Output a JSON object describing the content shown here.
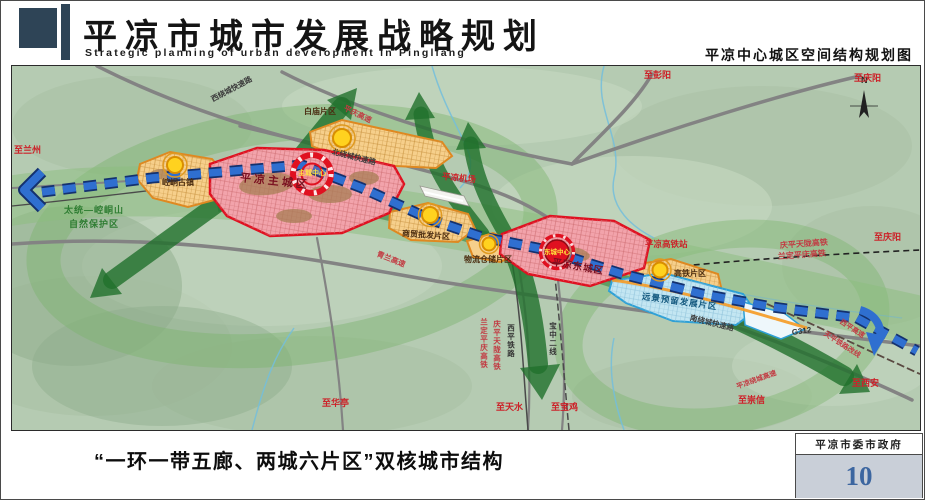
{
  "header": {
    "title_cn": "平凉市城市发展战略规划",
    "title_en": "Strategic planning of urban development in Pingliang",
    "right_caption": "平凉中心城区空间结构规划图"
  },
  "map": {
    "compass": "N",
    "zones": {
      "main_city": "平凉主城区",
      "east_city": "平凉东城区",
      "baimiao": "白庙片区",
      "kongtong": "崆峒古镇",
      "shangmao": "商贸批发片区",
      "wuliu": "物流仓储片区",
      "gaotie": "高铁片区",
      "yuanjing": "远景预留发展片区"
    },
    "centers": {
      "main": "主城中心",
      "east": "东城中心"
    },
    "stations": {
      "hsr": "平凉高铁站",
      "airport": "平凉机场"
    },
    "roads": {
      "west_ring": "西绕城快速路",
      "north_ring": "北绕城快速路",
      "south_ring": "南绕城快速路",
      "pingqing_expwy": "平庆高速",
      "qinglan_expwy": "青兰高速",
      "raocheng_expwy": "平凉绕城高速",
      "g312": "G312"
    },
    "railways": {
      "qptl_hsr": "庆平天陇高铁",
      "ldpq_hsr": "兰定平庆高铁",
      "xiping_rail": "西平铁路",
      "baozhong_2": "宝中二线",
      "xiping_expwy": "西平高速",
      "tianping_realign": "天平铁路改线"
    },
    "destinations": {
      "lanzhou": "至兰州",
      "pengyang": "至彭阳",
      "qingyang_top": "至庆阳",
      "qingyang_east": "至庆阳",
      "xian": "至西安",
      "chongxin": "至崇信",
      "huating": "至华亭",
      "tianshui": "至天水",
      "baoji": "至宝鸡"
    },
    "nature_reserve": {
      "line1": "太统—崆峒山",
      "line2": "自然保护区"
    }
  },
  "footer": {
    "caption": "“一环一带五廊、两城六片区”双核城市结构",
    "credit": "平凉市委市政府",
    "page_number": "10"
  },
  "colors": {
    "accent_dark_blue": "#2e4456",
    "city_red": "#e01020",
    "district_orange": "#e8971e",
    "reserve_cyan": "#35a3d5",
    "axis_blue": "#2f6fd0",
    "corridor_green": "#2a7a36",
    "page_number_blue": "#3c66a0"
  }
}
